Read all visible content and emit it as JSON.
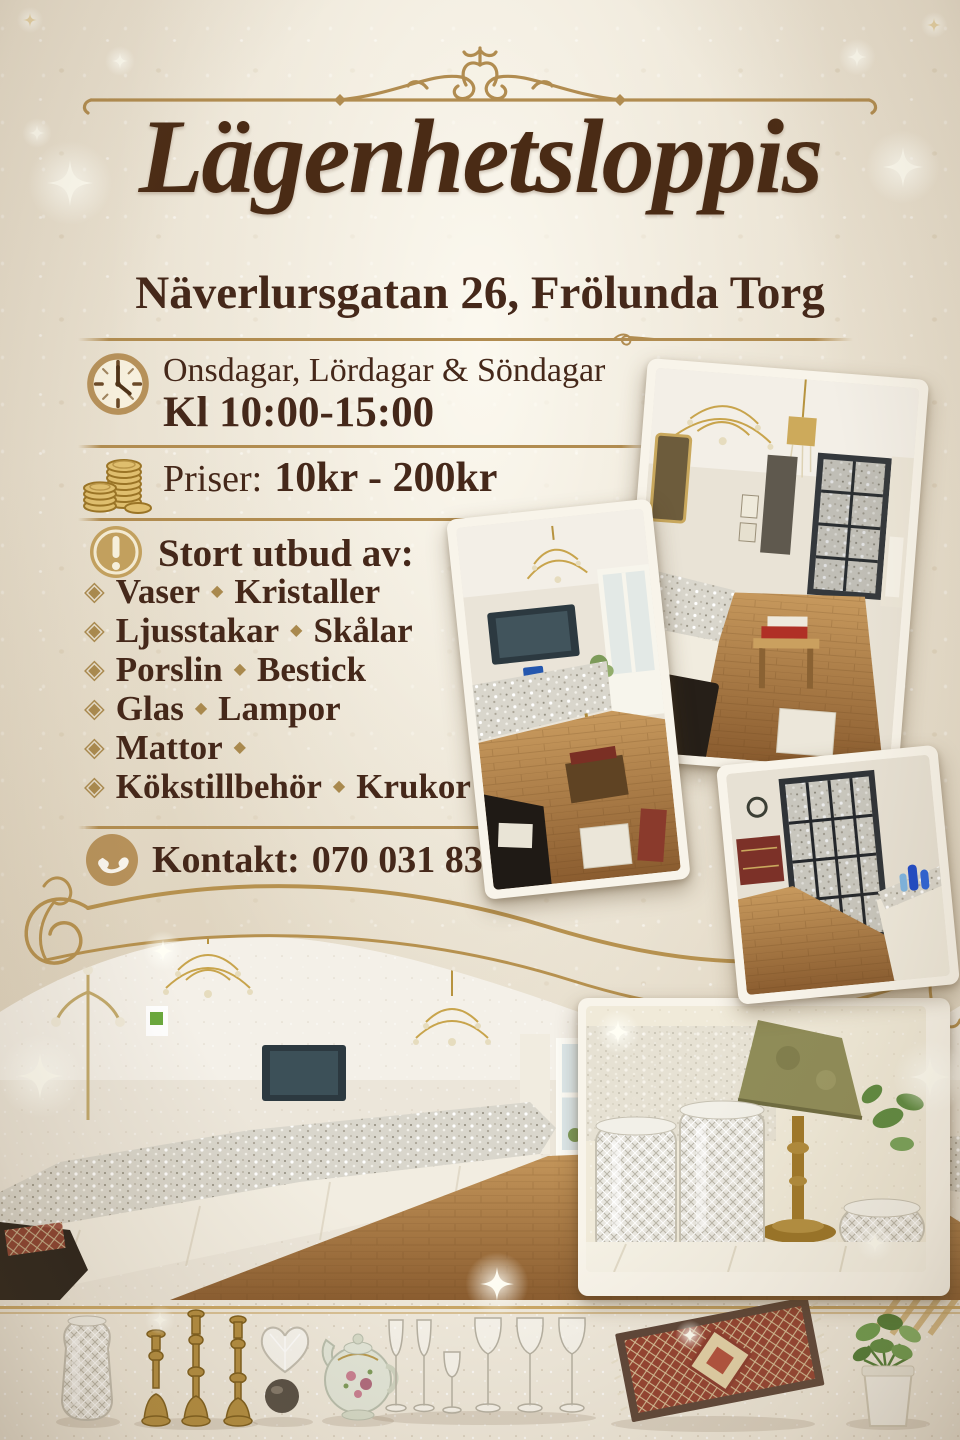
{
  "header": {
    "title": "Lägenhetsloppis",
    "address": "Näverlursgatan 26, Frölunda Torg"
  },
  "info": {
    "schedule": {
      "days": "Onsdagar, Lördagar & Söndagar",
      "hours": "Kl 10:00-15:00"
    },
    "prices": {
      "label": "Priser:",
      "value": "10kr - 200kr"
    },
    "assortment": {
      "heading": "Stort utbud av:",
      "items": [
        {
          "first": "Vaser",
          "second": "Kristaller"
        },
        {
          "first": "Ljusstakar",
          "second": "Skålar"
        },
        {
          "first": "Porslin",
          "second": "Bestick"
        },
        {
          "first": "Glas",
          "second": "Lampor"
        },
        {
          "first": "Mattor",
          "second": ""
        },
        {
          "first": "Kökstillbehör",
          "second": "Krukor"
        }
      ]
    },
    "contact": {
      "label": "Kontakt:",
      "phone": "070 031 83 46"
    }
  },
  "icons": {
    "bullet_glyph": "◈",
    "separator_glyph": "◆",
    "clock": "clock-icon",
    "coins": "coins-icon",
    "alert": "exclamation-icon",
    "phone": "phone-icon"
  },
  "colors": {
    "background": "#e8e0d0",
    "text_brown": "#45281a",
    "title_brown": "#4a2b15",
    "gold": "#b18c50",
    "coin_gold": "#dfbe6e",
    "photo_frame": "#f8f4ea"
  },
  "photos": {
    "top_right": "apartment-room-with-chandeliers-and-sale-tables",
    "middle_left": "living-room-with-glassware-tables",
    "bottom_right_small": "display-cabinet-and-table-with-blue-glass",
    "panorama": "wide-apartment-view-with-long-glassware-table",
    "crystal_closeup": "crystal-vases-bowl-and-green-table-lamp",
    "bottom_strip": "sale-items-vase-candlesticks-teapot-glasses-rug-plant"
  }
}
